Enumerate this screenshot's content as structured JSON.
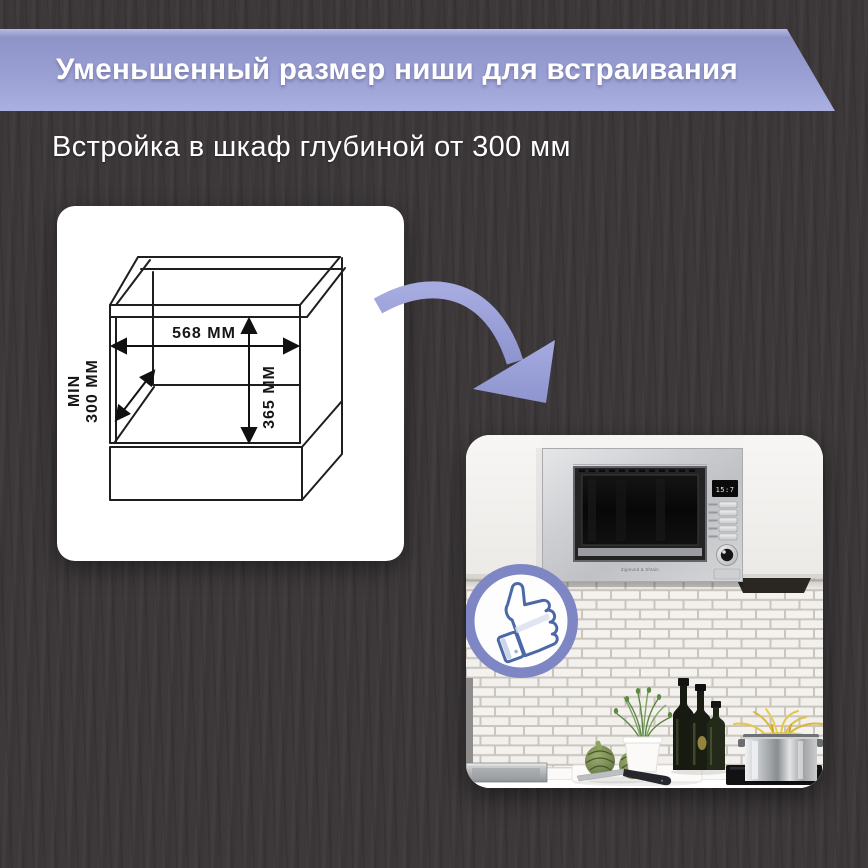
{
  "page": {
    "background_color": "#3b3738"
  },
  "banner": {
    "title": "Уменьшенный размер ниши для встраивания",
    "color_top": "#9298cc",
    "color_bottom": "#abb0e1",
    "text_color": "#ffffff"
  },
  "subtitle": {
    "text": "Встройка в шкаф глубиной от 300 мм"
  },
  "diagram": {
    "width_label": "568 ММ",
    "height_label": "365 ММ",
    "depth_label_line1": "MIN",
    "depth_label_line2": "300 ММ"
  },
  "arrow": {
    "icon": "curved-arrow-down-right",
    "color": "#99a0d8"
  },
  "photo": {
    "badge": {
      "icon": "thumbs-up",
      "ring_color": "#7e86c3",
      "thumb_outline_color": "#4d68a8"
    },
    "microwave": {
      "brand_label": "Zigmund & Shtain",
      "display_text": "15:7"
    }
  }
}
